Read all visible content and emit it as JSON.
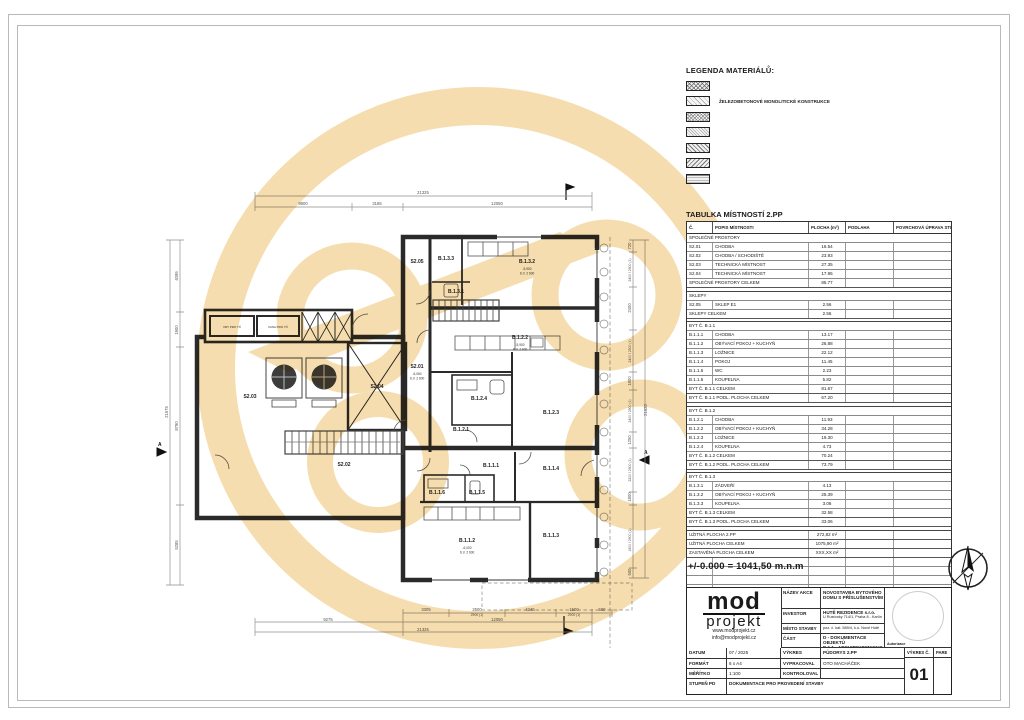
{
  "legend": {
    "title": "LEGENDA MATERIÁLŮ:",
    "items": [
      {
        "label": ""
      },
      {
        "label": "ŽELEZOBETONOVÉ MONOLITICKÉ KONSTRUKCE"
      },
      {
        "label": ""
      },
      {
        "label": ""
      },
      {
        "label": ""
      },
      {
        "label": ""
      },
      {
        "label": ""
      }
    ]
  },
  "room_table": {
    "title": "TABULKA MÍSTNOSTÍ 2.PP",
    "columns": [
      "Č.",
      "POPIS MÍSTNOSTI",
      "PLOCHA (m²)",
      "PODLAHA",
      "POVRCHOVÁ ÚPRAVA STĚNY"
    ],
    "rows": [
      {
        "type": "section",
        "c": "SPOLEČNÉ PROSTORY",
        "p": "",
        "a": "",
        "f1": "",
        "f2": ""
      },
      {
        "c": "S2.01",
        "p": "CHODBA",
        "a": "16.54",
        "f1": "",
        "f2": ""
      },
      {
        "c": "S2.02",
        "p": "CHODBA / SCHODIŠTĚ",
        "a": "23.93",
        "f1": "",
        "f2": ""
      },
      {
        "c": "S2.03",
        "p": "TECHNICKÁ MÍSTNOST",
        "a": "27.35",
        "f1": "",
        "f2": ""
      },
      {
        "c": "S2.04",
        "p": "TECHNICKÁ MÍSTNOST",
        "a": "17.95",
        "f1": "",
        "f2": ""
      },
      {
        "type": "total",
        "c": "SPOLEČNÉ PROSTORY CELKEM",
        "p": "",
        "a": "85.77",
        "f1": "",
        "f2": ""
      },
      {
        "type": "gap"
      },
      {
        "type": "section",
        "c": "SKLEPY",
        "p": "",
        "a": "",
        "f1": "",
        "f2": ""
      },
      {
        "c": "S2.05",
        "p": "SKLEP E1",
        "a": "2.56",
        "f1": "",
        "f2": ""
      },
      {
        "type": "total",
        "c": "SKLEPY CELKEM",
        "p": "",
        "a": "2.56",
        "f1": "",
        "f2": ""
      },
      {
        "type": "gap"
      },
      {
        "type": "section",
        "c": "BYT Č. B.1.1",
        "p": "",
        "a": "",
        "f1": "",
        "f2": ""
      },
      {
        "c": "B.1.1.1",
        "p": "CHODBA",
        "a": "13.17",
        "f1": "",
        "f2": ""
      },
      {
        "c": "B.1.1.2",
        "p": "OBÝVACÍ POKOJ + KUCHYŇ",
        "a": "26.88",
        "f1": "",
        "f2": ""
      },
      {
        "c": "B.1.1.3",
        "p": "LOŽNICE",
        "a": "22.12",
        "f1": "",
        "f2": ""
      },
      {
        "c": "B.1.1.4",
        "p": "POKOJ",
        "a": "11.45",
        "f1": "",
        "f2": ""
      },
      {
        "c": "B.1.1.5",
        "p": "WC",
        "a": "2.23",
        "f1": "",
        "f2": ""
      },
      {
        "c": "B.1.1.6",
        "p": "KOUPELNA",
        "a": "5.82",
        "f1": "",
        "f2": ""
      },
      {
        "type": "total",
        "c": "BYT Č. B.1.1 CELKEM",
        "p": "",
        "a": "81.67",
        "f1": "",
        "f2": ""
      },
      {
        "type": "total",
        "c": "BYT Č. B.1.1 PODL. PLOCHA CELKEM",
        "p": "",
        "a": "67.20",
        "f1": "",
        "f2": ""
      },
      {
        "type": "gap"
      },
      {
        "type": "section",
        "c": "BYT Č. B.1.2",
        "p": "",
        "a": "",
        "f1": "",
        "f2": ""
      },
      {
        "c": "B.1.2.1",
        "p": "CHODBA",
        "a": "11.93",
        "f1": "",
        "f2": ""
      },
      {
        "c": "B.1.2.2",
        "p": "OBÝVACÍ POKOJ + KUCHYŇ",
        "a": "34.28",
        "f1": "",
        "f2": ""
      },
      {
        "c": "B.1.2.3",
        "p": "LOŽNICE",
        "a": "19.30",
        "f1": "",
        "f2": ""
      },
      {
        "c": "B.1.2.4",
        "p": "KOUPELNA",
        "a": "4.73",
        "f1": "",
        "f2": ""
      },
      {
        "type": "total",
        "c": "BYT Č. B.1.2 CELKEM",
        "p": "",
        "a": "70.24",
        "f1": "",
        "f2": ""
      },
      {
        "type": "total",
        "c": "BYT Č. B.1.2 PODL. PLOCHA CELKEM",
        "p": "",
        "a": "73.79",
        "f1": "",
        "f2": ""
      },
      {
        "type": "gap"
      },
      {
        "type": "section",
        "c": "BYT Č. B.1.3",
        "p": "",
        "a": "",
        "f1": "",
        "f2": ""
      },
      {
        "c": "B.1.3.1",
        "p": "ZÁDVEŘÍ",
        "a": "4.13",
        "f1": "",
        "f2": ""
      },
      {
        "c": "B.1.3.2",
        "p": "OBÝVACÍ POKOJ + KUCHYŇ",
        "a": "25.39",
        "f1": "",
        "f2": ""
      },
      {
        "c": "B.1.3.3",
        "p": "KOUPELNA",
        "a": "3.06",
        "f1": "",
        "f2": ""
      },
      {
        "type": "total",
        "c": "BYT Č. B.1.3 CELKEM",
        "p": "",
        "a": "32.58",
        "f1": "",
        "f2": ""
      },
      {
        "type": "total",
        "c": "BYT Č. B.1.3 PODL. PLOCHA CELKEM",
        "p": "",
        "a": "33.06",
        "f1": "",
        "f2": ""
      },
      {
        "type": "gap"
      },
      {
        "type": "total",
        "c": "UŽITNÁ PLOCHA 2.PP",
        "p": "",
        "a": "272,82 m²",
        "f1": "",
        "f2": ""
      },
      {
        "type": "total",
        "c": "UŽITNÁ PLOCHA CELKEM",
        "p": "",
        "a": "1075,90 m²",
        "f1": "",
        "f2": ""
      },
      {
        "type": "total",
        "c": "ZASTAVĚNÁ PLOCHA CELKEM",
        "p": "",
        "a": "XXX,XX m²",
        "f1": "",
        "f2": ""
      },
      {
        "type": "empty",
        "c": "",
        "p": "",
        "a": "",
        "f1": "",
        "f2": ""
      },
      {
        "type": "empty",
        "c": "",
        "p": "",
        "a": "",
        "f1": "",
        "f2": ""
      },
      {
        "type": "empty",
        "c": "",
        "p": "",
        "a": "",
        "f1": "",
        "f2": ""
      },
      {
        "type": "empty",
        "c": "",
        "p": "",
        "a": "",
        "f1": "",
        "f2": ""
      },
      {
        "type": "empty",
        "c": "",
        "p": "",
        "a": "",
        "f1": "",
        "f2": ""
      }
    ]
  },
  "elevation_note": "+/-0.000 = 1041,50 m.n.m",
  "plan": {
    "rooms": [
      {
        "id": "S2.05"
      },
      {
        "id": "B.1.3.3"
      },
      {
        "id": "B.1.3.1"
      },
      {
        "id": "B.1.3.2",
        "sub": "-5,900",
        "sv": "S.V. 2 600"
      },
      {
        "id": "B.1.2.2",
        "sub": "-5,900",
        "sv": "S.V. 2 600"
      },
      {
        "id": "S2.01",
        "sub": "-6,060",
        "sv": "S.V. 2 600"
      },
      {
        "id": "S2.03"
      },
      {
        "id": "S2.04"
      },
      {
        "id": "S2.02"
      },
      {
        "id": "B.1.2.4"
      },
      {
        "id": "B.1.2.1"
      },
      {
        "id": "B.1.2.3"
      },
      {
        "id": "B.1.1.1"
      },
      {
        "id": "B.1.1.4"
      },
      {
        "id": "B.1.1.6"
      },
      {
        "id": "B.1.1.5"
      },
      {
        "id": "B.1.1.2",
        "sub": "-6,000",
        "sv": "S.V. 2 600"
      },
      {
        "id": "B.1.1.3"
      }
    ],
    "annex": {
      "a1": "VRT PRO TČ",
      "a2": "VANA PRO TČ"
    },
    "section_mark": "A",
    "dims": {
      "top_overall": "21325",
      "top": [
        "9800",
        "3185",
        "12050"
      ],
      "bottom_row1": [
        "3305",
        "2500",
        "2900 (1)",
        "4245",
        "1500",
        "2900 (1)",
        "500"
      ],
      "bottom_row2": [
        "9275",
        "12050"
      ],
      "bottom_overall": "21325",
      "left": [
        "4095",
        "1900",
        "8790",
        "5285"
      ],
      "left_overall": "21675",
      "right": [
        "720",
        "2400 / 2900 (1)",
        "2400",
        "2400 / 2500 (1)",
        "1800",
        "2400 / 2900 (1)",
        "1250",
        "2200 / 2900 (1)",
        "1800",
        "1900 / 2900 (1)",
        "500"
      ],
      "right_overall": "21620"
    }
  },
  "title_block": {
    "logo": {
      "line1": "mod",
      "line2": "projekt",
      "web": "www.modprojekt.cz",
      "email": "info@modprojekt.cz"
    },
    "nazev_akce_label": "NÁZEV AKCE",
    "nazev_akce": "NOVOSTAVBA BYTOVÉHO DOMU S PŘÍSLUŠENSTVÍM",
    "investor_label": "INVESTOR",
    "investor1": "HUTĚ REZIDENCE s.r.o.",
    "investor2": "U Rustonky 714/1, Praha 8 - Karlín",
    "misto_label": "MÍSTO STAVBY",
    "misto": "poz. č. kat. 589/4, k.ú. Nové Hutě",
    "cast_label": "ČÁST",
    "cast1": "D - DOKUMENTACE OBJEKTŮ",
    "cast2": "D.1.1 - ARCHITEKTONICKO - STAVEBNÍ",
    "autorizace_label": "Autorizace",
    "datum_label": "DATUM",
    "datum": "07 / 2025",
    "format_label": "FORMÁT",
    "format": "6 x A4",
    "meritko_label": "MĚŘÍTKO",
    "meritko": "1:100",
    "stupen_label": "STUPEŇ PD",
    "stupen": "DOKUMENTACE PRO PROVEDENÍ STAVBY",
    "vykres_label": "VÝKRES",
    "vykres": "PŮDORYS 2.PP",
    "vypracoval_label": "VYPRACOVAL",
    "vypracoval": "OTO MACHÁČEK",
    "kontroloval_label": "KONTROLOVAL",
    "kontroloval": "",
    "vykres_c_label": "VÝKRES Č.",
    "vykres_c": "01",
    "pare_label": "PARE"
  },
  "colors": {
    "watermark": "#E9B44C",
    "line": "#2a2a2a",
    "dim": "#6f6f6f"
  }
}
